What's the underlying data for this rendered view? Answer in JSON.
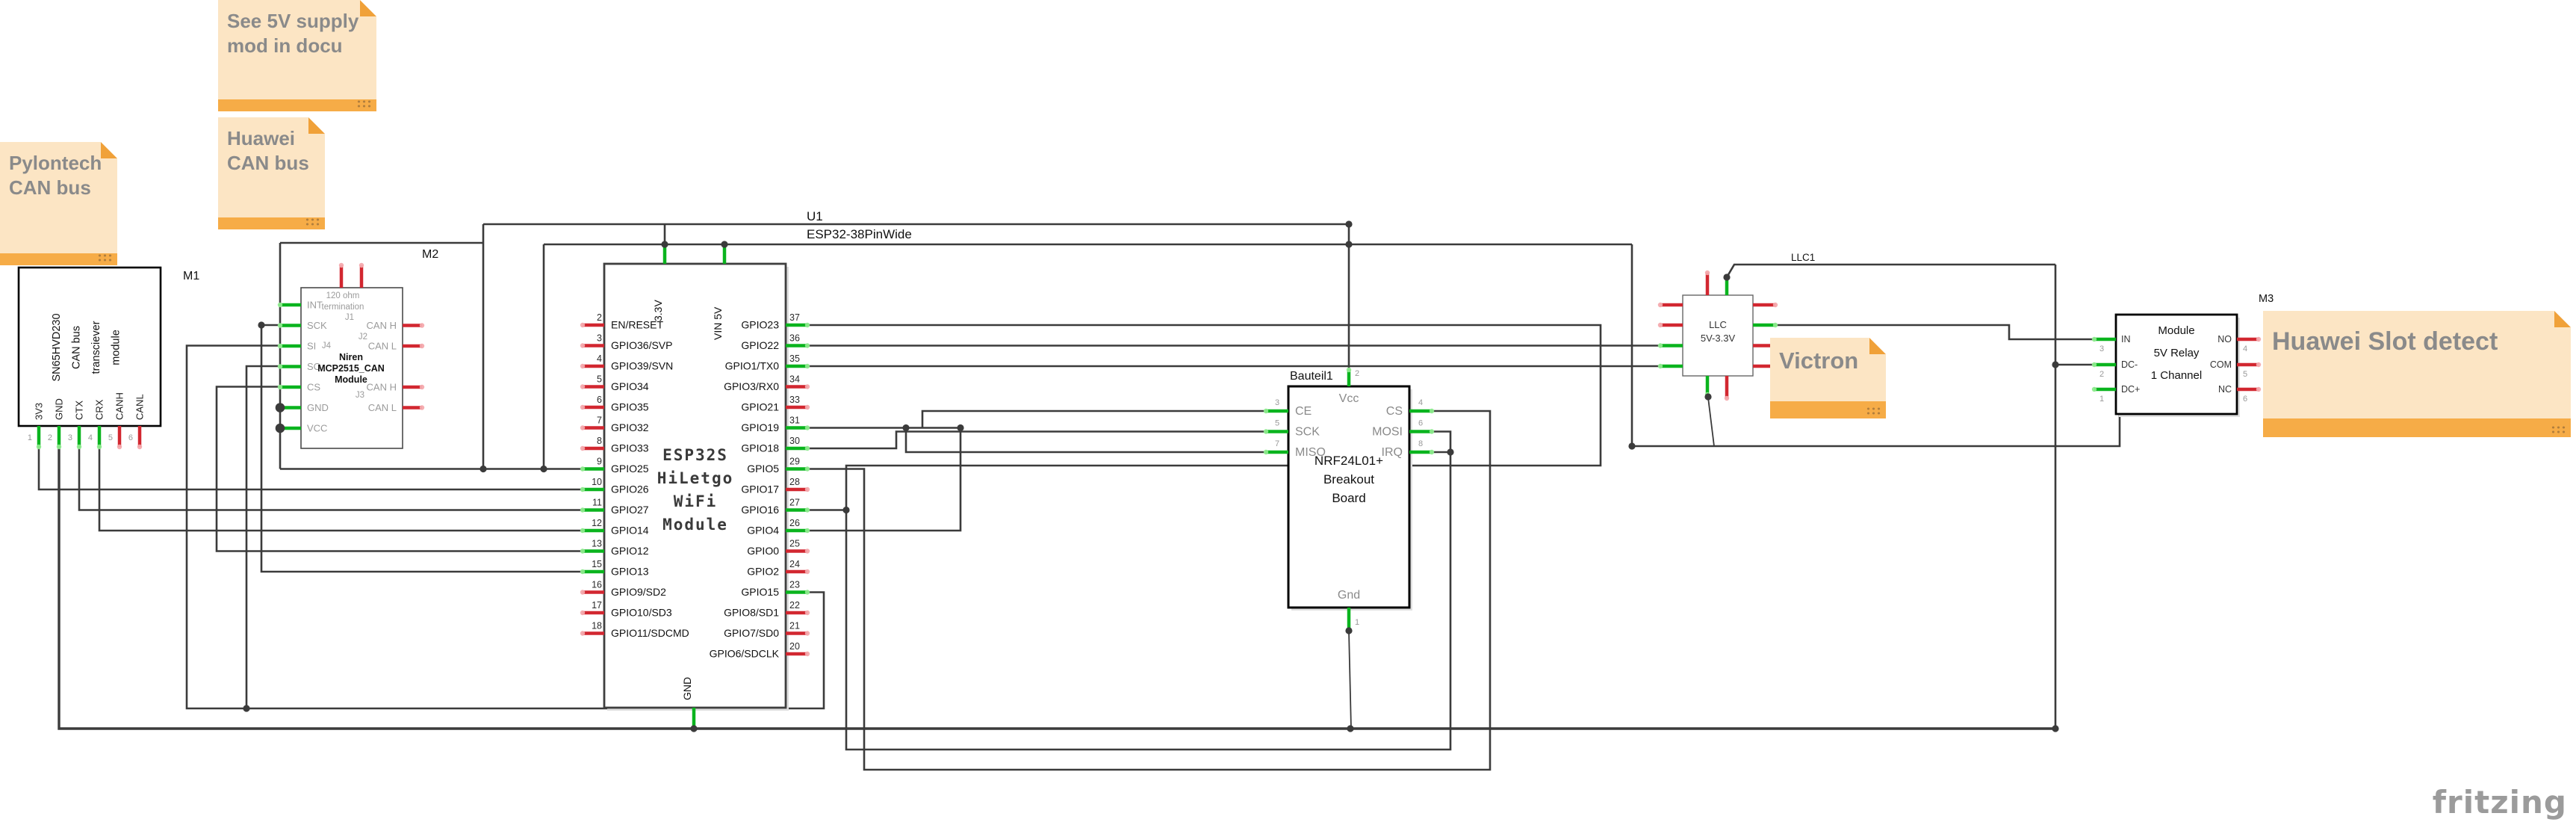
{
  "diagram": {
    "background": "#ffffff",
    "wire_color": "#3b3b3b",
    "pin_green": "#0ab41e",
    "pin_green_cap": "#8deb8d",
    "pin_red": "#d22730",
    "pin_red_cap": "#f4a9ad",
    "note_fill": "#fce5c4",
    "note_strip": "#f6ac47"
  },
  "notes": {
    "supply": {
      "lines": [
        "See 5V supply",
        "mod in docu"
      ]
    },
    "huawei_can": {
      "lines": [
        "Huawei",
        "CAN bus"
      ]
    },
    "pylontech": {
      "lines": [
        "Pylontech",
        "CAN bus"
      ]
    },
    "victron": {
      "lines": [
        "Victron"
      ]
    },
    "huawei_slot": {
      "lines": [
        "Huawei Slot detect"
      ]
    }
  },
  "modules": {
    "m1": {
      "ref": "M1",
      "title_lines": [
        "SN65HVD230",
        "CAN bus",
        "transciever",
        "module"
      ],
      "pins": [
        {
          "n": "1",
          "label": "3V3",
          "c": "g"
        },
        {
          "n": "2",
          "label": "GND",
          "c": "g"
        },
        {
          "n": "3",
          "label": "CTX",
          "c": "g"
        },
        {
          "n": "4",
          "label": "CRX",
          "c": "g"
        },
        {
          "n": "5",
          "label": "CANH",
          "c": "r"
        },
        {
          "n": "6",
          "label": "CANL",
          "c": "r"
        }
      ]
    },
    "m2": {
      "ref": "M2",
      "title_lines": [
        "Niren",
        "MCP2515_CAN",
        "Module"
      ],
      "top_note": [
        "120 ohm",
        "termination"
      ],
      "j_labels": [
        "J1",
        "J2",
        "J3",
        "J4"
      ],
      "left_pins": [
        {
          "label": "INT",
          "c": "g"
        },
        {
          "label": "SCK",
          "c": "g"
        },
        {
          "label": "SI",
          "c": "g"
        },
        {
          "label": "SO",
          "c": "g"
        },
        {
          "label": "CS",
          "c": "g"
        },
        {
          "label": "GND",
          "c": "g"
        },
        {
          "label": "VCC",
          "c": "g"
        }
      ],
      "right_pins": [
        {
          "label": "CAN H",
          "c": "r"
        },
        {
          "label": "CAN L",
          "c": "r"
        },
        {
          "label": "CAN H",
          "c": "r"
        },
        {
          "label": "CAN L",
          "c": "r"
        }
      ]
    },
    "u1": {
      "ref": "U1",
      "part": "ESP32-38PinWide",
      "title_lines": [
        "ESP32S",
        "HiLetgo",
        "WiFi",
        "Module"
      ],
      "top_pins": [
        {
          "label": "3.3V",
          "c": "g"
        },
        {
          "label": "VIN 5V",
          "c": "g"
        }
      ],
      "bottom_pins": [
        {
          "label": "GND",
          "c": "g"
        }
      ],
      "left_pins": [
        {
          "n": "2",
          "label": "EN/RESET",
          "c": "r"
        },
        {
          "n": "3",
          "label": "GPIO36/SVP",
          "c": "r"
        },
        {
          "n": "4",
          "label": "GPIO39/SVN",
          "c": "r"
        },
        {
          "n": "5",
          "label": "GPIO34",
          "c": "r"
        },
        {
          "n": "6",
          "label": "GPIO35",
          "c": "r"
        },
        {
          "n": "7",
          "label": "GPIO32",
          "c": "r"
        },
        {
          "n": "8",
          "label": "GPIO33",
          "c": "r"
        },
        {
          "n": "9",
          "label": "GPIO25",
          "c": "g"
        },
        {
          "n": "10",
          "label": "GPIO26",
          "c": "g"
        },
        {
          "n": "11",
          "label": "GPIO27",
          "c": "g"
        },
        {
          "n": "12",
          "label": "GPIO14",
          "c": "g"
        },
        {
          "n": "13",
          "label": "GPIO12",
          "c": "g"
        },
        {
          "n": "15",
          "label": "GPIO13",
          "c": "g"
        },
        {
          "n": "16",
          "label": "GPIO9/SD2",
          "c": "r"
        },
        {
          "n": "17",
          "label": "GPIO10/SD3",
          "c": "r"
        },
        {
          "n": "18",
          "label": "GPIO11/SDCMD",
          "c": "r"
        }
      ],
      "right_pins": [
        {
          "n": "37",
          "label": "GPIO23",
          "c": "g"
        },
        {
          "n": "36",
          "label": "GPIO22",
          "c": "g"
        },
        {
          "n": "35",
          "label": "GPIO1/TX0",
          "c": "g"
        },
        {
          "n": "34",
          "label": "GPIO3/RX0",
          "c": "r"
        },
        {
          "n": "33",
          "label": "GPIO21",
          "c": "r"
        },
        {
          "n": "31",
          "label": "GPIO19",
          "c": "g"
        },
        {
          "n": "30",
          "label": "GPIO18",
          "c": "g"
        },
        {
          "n": "29",
          "label": "GPIO5",
          "c": "g"
        },
        {
          "n": "28",
          "label": "GPIO17",
          "c": "r"
        },
        {
          "n": "27",
          "label": "GPIO16",
          "c": "g"
        },
        {
          "n": "26",
          "label": "GPIO4",
          "c": "g"
        },
        {
          "n": "25",
          "label": "GPIO0",
          "c": "r"
        },
        {
          "n": "24",
          "label": "GPIO2",
          "c": "r"
        },
        {
          "n": "23",
          "label": "GPIO15",
          "c": "g"
        },
        {
          "n": "22",
          "label": "GPIO8/SD1",
          "c": "r"
        },
        {
          "n": "21",
          "label": "GPIO7/SD0",
          "c": "r"
        },
        {
          "n": "20",
          "label": "GPIO6/SDCLK",
          "c": "r"
        }
      ]
    },
    "nrf": {
      "ref": "Bauteil1",
      "title_lines": [
        "NRF24L01+",
        "Breakout",
        "Board"
      ],
      "top_pin": {
        "n": "2",
        "label": "Vcc"
      },
      "bottom_pin": {
        "n": "1",
        "label": "Gnd"
      },
      "left_pins": [
        {
          "n": "3",
          "label": "CE",
          "c": "g"
        },
        {
          "n": "5",
          "label": "SCK",
          "c": "g"
        },
        {
          "n": "7",
          "label": "MISO",
          "c": "g"
        }
      ],
      "right_pins": [
        {
          "n": "4",
          "label": "CS",
          "c": "g"
        },
        {
          "n": "6",
          "label": "MOSI",
          "c": "g"
        },
        {
          "n": "8",
          "label": "IRQ",
          "c": "g"
        }
      ]
    },
    "llc": {
      "ref": "LLC1",
      "title_lines": [
        "LLC",
        "5V-3.3V"
      ]
    },
    "m3": {
      "ref": "M3",
      "title_lines": [
        "Module",
        "5V Relay",
        "1 Channel"
      ],
      "left_pins": [
        {
          "n": "3",
          "label": "IN",
          "c": "g"
        },
        {
          "n": "2",
          "label": "DC-",
          "c": "g"
        },
        {
          "n": "1",
          "label": "DC+",
          "c": "g"
        }
      ],
      "right_pins": [
        {
          "n": "4",
          "label": "NO",
          "c": "r"
        },
        {
          "n": "5",
          "label": "COM",
          "c": "r"
        },
        {
          "n": "6",
          "label": "NC",
          "c": "r"
        }
      ]
    }
  },
  "logo": {
    "text": "fritzing"
  }
}
